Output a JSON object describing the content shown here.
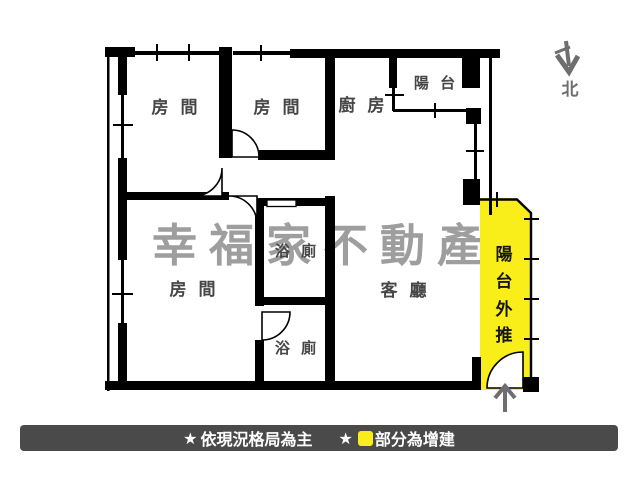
{
  "floorplan": {
    "watermark": "幸福家不動產",
    "rooms": {
      "bedroom1": "房 間",
      "bedroom2": "房 間",
      "bedroom3": "房 間",
      "kitchen": "廚 房",
      "balcony": "陽 台",
      "bathroom1": "浴 廁",
      "bathroom2": "浴 廁",
      "living_room": "客 廳"
    },
    "balcony_extension": {
      "chars": [
        "陽",
        "台",
        "外",
        "推"
      ],
      "fill_color": "#f9ed1a"
    },
    "north": {
      "label": "北"
    }
  },
  "footer": {
    "star": "★",
    "note_current_layout": "依現況格局為主",
    "note_addition": "部分為增建",
    "bar_color": "#4a4a4a",
    "legend_square_color": "#f9ed1a"
  },
  "colors": {
    "wall": "#000000",
    "watermark": "#9e9e9e",
    "room_label": "#464646",
    "arrow_gray": "#6e6e6e",
    "highlight_yellow": "#f9ed1a"
  }
}
